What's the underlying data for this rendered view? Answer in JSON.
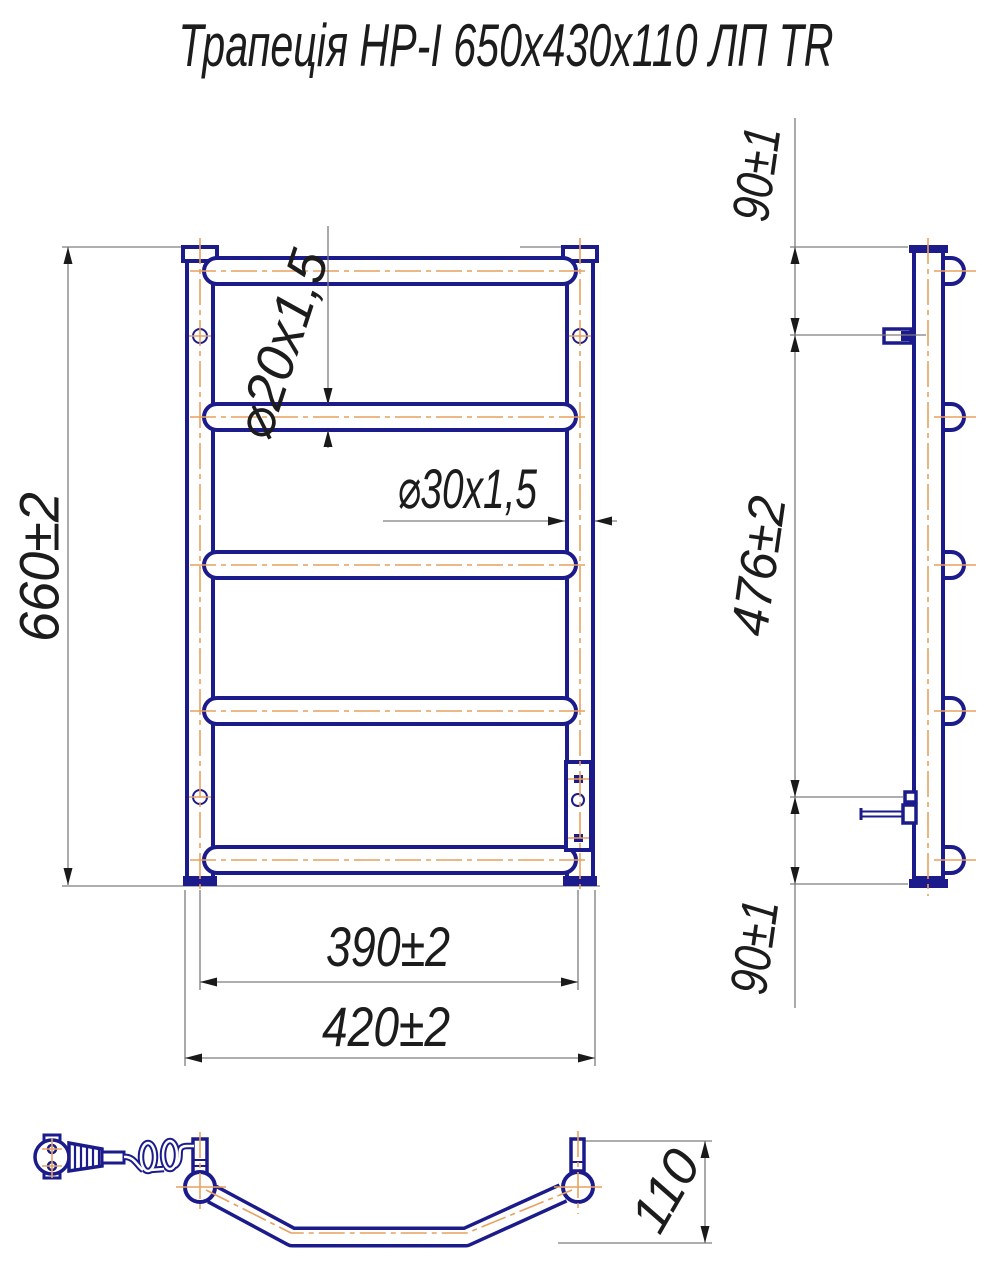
{
  "title": "Трапеція НР-І 650х430х110 ЛП TR",
  "dimensions": {
    "height": "660±2",
    "rung_diameter": "⌀20х1,5",
    "collector_diameter": "⌀30х1,5",
    "rung_span": "390±2",
    "overall_width": "420±2",
    "top_bracket_offset": "90±1",
    "bracket_span": "476±2",
    "bottom_bracket_offset": "90±1",
    "depth": "110"
  },
  "colors": {
    "outline_navy": "#1b1b8c",
    "centerline_orange": "#e8a15e",
    "dimension_gray": "#7d7d7d",
    "text_black": "#1c1c1c"
  }
}
